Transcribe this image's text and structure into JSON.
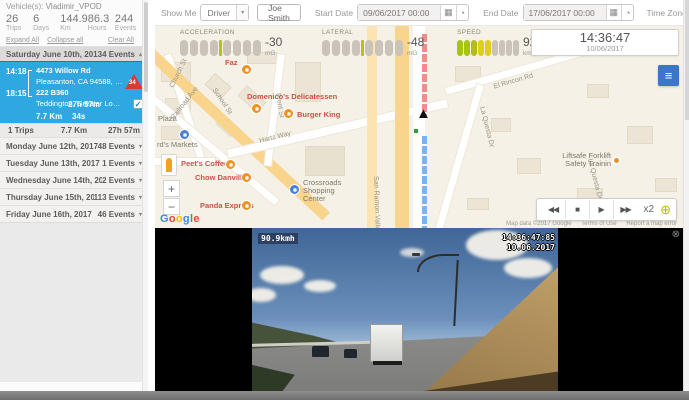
{
  "colors": {
    "accent_blue": "#2fa7e1",
    "generate_blue": "#4e95d9",
    "alert_red": "#e0392e",
    "route_red": "#f08c8c",
    "route_blue": "#78b4f0",
    "gauge_indicator": "#b5c40e",
    "menu_button_blue": "#3b76c8"
  },
  "icons": {
    "dropdown": "▾",
    "caret_up": "▴",
    "calendar": "▦",
    "clock": "◔",
    "rewind": "◀◀",
    "stop": "■",
    "play": "▶",
    "fast_forward": "▶▶",
    "crosshair": "⊕",
    "menu": "≡",
    "close": "⊗",
    "zoom_in": "+",
    "zoom_out": "−",
    "check": "✓"
  },
  "sidebar": {
    "vehicles_label": "Vehicle(s):",
    "vehicle_name": "Vladimir_VPOD",
    "stats": [
      {
        "value": "26",
        "label": "Trips"
      },
      {
        "value": "6",
        "label": "Days"
      },
      {
        "value": "144.9",
        "label": "Km"
      },
      {
        "value": "86.3",
        "label": "Hours"
      },
      {
        "value": "244",
        "label": "Events"
      }
    ],
    "links": {
      "expand": "Expand All",
      "collapse": "Collapse all",
      "clear": "Clear All"
    },
    "selected_day": {
      "date": "Saturday June 10th, 2017",
      "events": "34 Events"
    },
    "trip": {
      "start_time": "14:18",
      "end_time": "18:15",
      "start_address1": "4473 Willow Rd",
      "start_address2": "Pleasanton, CA 94588, USA",
      "end_address1": "222 B360",
      "end_address2": "Teddington, Greater London T...",
      "alert_count": "34",
      "duration": "27h 57m",
      "distance": "7.7 Km",
      "stop_time": "34s"
    },
    "day_summary": {
      "trips": "1 Trips",
      "distance": "7.7 Km",
      "duration": "27h 57m"
    },
    "days": [
      {
        "date": "Monday June 12th, 2017",
        "events": "48 Events"
      },
      {
        "date": "Tuesday June 13th, 2017",
        "events": "1 Events"
      },
      {
        "date": "Wednesday June 14th, 2017",
        "events": "2 Events"
      },
      {
        "date": "Thursday June 15th, 2017",
        "events": "113 Events"
      },
      {
        "date": "Friday June 16th, 2017",
        "events": "46 Events"
      }
    ]
  },
  "toolbar": {
    "show_me_label": "Show Me",
    "show_me_value": "Driver",
    "driver_name": "Joe Smith",
    "start_date_label": "Start Date",
    "start_date_value": "09/06/2017 00:00",
    "end_date_label": "End Date",
    "end_date_value": "17/06/2017 00:00",
    "timezone_label": "Time Zone",
    "timezone_value": "-08:00",
    "generate_label": "Generate"
  },
  "gauges": {
    "acceleration": {
      "label": "ACCELERATION",
      "value": "-30",
      "unit": "mG",
      "bars_left": [
        "#c9c3b9",
        "#c9c3b9",
        "#c9c3b9",
        "#c9c3b9"
      ],
      "bars_right": [
        "#c9c3b9",
        "#c9c3b9",
        "#c9c3b9",
        "#c9c3b9"
      ]
    },
    "lateral": {
      "label": "LATERAL",
      "value": "-48",
      "unit": "mG",
      "bars_left": [
        "#c9c3b9",
        "#c9c3b9",
        "#c9c3b9",
        "#c9c3b9"
      ],
      "bars_right": [
        "#c9c3b9",
        "#c9c3b9",
        "#c9c3b9",
        "#c9c3b9"
      ]
    },
    "speed": {
      "label": "SPEED",
      "value": "92",
      "unit": "km/h",
      "bars": [
        "#a6c410",
        "#a6c410",
        "#b4bd12",
        "#e0cd1d",
        "#e0cd1d",
        "#c9c3b9",
        "#c9c3b9",
        "#c9c3b9",
        "#c9c3b9"
      ]
    }
  },
  "clock": {
    "time": "14:36:47",
    "date": "10/06/2017"
  },
  "map": {
    "streets": [
      "Church St",
      "Railroad Ave",
      "School St",
      "Front St",
      "Hartz Way",
      "San Ramon Valley B",
      "El Rincon Rd",
      "La Questa Dr"
    ],
    "pois": [
      {
        "label": "Faz"
      },
      {
        "label": "Domenico's Delicatessen"
      },
      {
        "label": "Burger King"
      },
      {
        "label": "Plaza"
      },
      {
        "label": "rd's Markets"
      },
      {
        "label": "Peet's Coffee"
      },
      {
        "label": "Chow Danville"
      },
      {
        "label": "Panda Express"
      },
      {
        "label": "Crossroads Shopping Center"
      },
      {
        "label": "Liftsafe Forklift Safety Trainin"
      }
    ],
    "google_logo": [
      {
        "ch": "G",
        "color": "#4285F4"
      },
      {
        "ch": "o",
        "color": "#EA4335"
      },
      {
        "ch": "o",
        "color": "#FBBC05"
      },
      {
        "ch": "g",
        "color": "#4285F4"
      },
      {
        "ch": "l",
        "color": "#34A853"
      },
      {
        "ch": "e",
        "color": "#EA4335"
      }
    ],
    "attribution": "Map data ©2017 Google",
    "terms": "Terms of Use",
    "report": "Report a map error",
    "playback_speed": "x2"
  },
  "video": {
    "speed_overlay": "90.9kmh",
    "timestamp_time": "14:36:47:85",
    "timestamp_date": "10.06.2017"
  }
}
